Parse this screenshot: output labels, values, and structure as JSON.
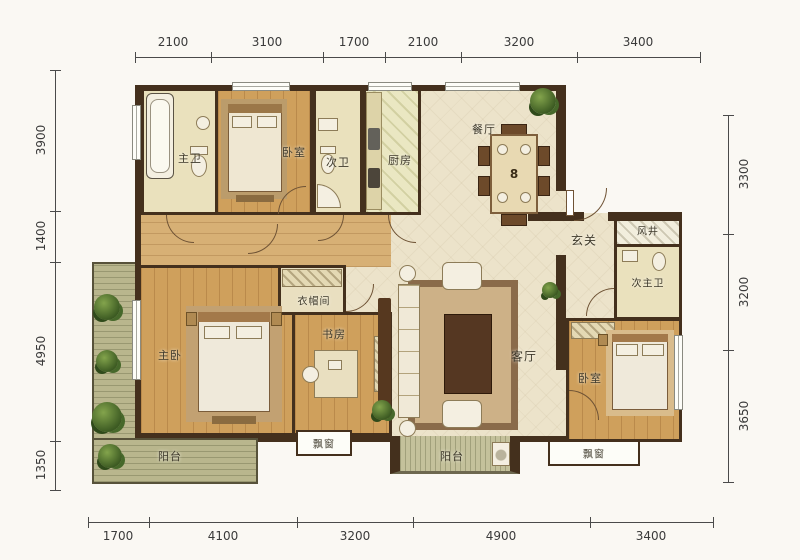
{
  "dimensions": {
    "top": [
      "2100",
      "3100",
      "1700",
      "2100",
      "3200",
      "3400"
    ],
    "bottom": [
      "1700",
      "4100",
      "3200",
      "4900",
      "3400"
    ],
    "left": [
      "3900",
      "1400",
      "4950",
      "1350"
    ],
    "right": [
      "3300",
      "3200",
      "3650"
    ]
  },
  "rooms": {
    "master_bath": "主卫",
    "bedroom_top": "卧室",
    "second_bath": "次卫",
    "kitchen": "厨房",
    "dining": "餐厅",
    "foyer": "玄关",
    "air_shaft": "风井",
    "second_master_bath": "次主卫",
    "cloakroom": "衣帽间",
    "master_bedroom": "主卧",
    "study": "书房",
    "living": "客厅",
    "bedroom_right": "卧室",
    "balcony_left": "阳台",
    "bay_window_left": "飘窗",
    "balcony_mid": "阳台",
    "bay_window_right": "飘窗"
  },
  "markers": {
    "dining_seats": "8"
  },
  "icons": [
    "plant-icon",
    "bathtub-icon",
    "toilet-icon",
    "sink-icon",
    "bed-icon",
    "sofa-icon",
    "armchair-icon",
    "coffee-table-icon",
    "dining-table-icon",
    "chair-icon",
    "desk-icon",
    "wardrobe-icon",
    "door-arc-icon",
    "window-icon",
    "washer-icon",
    "tv-cabinet-icon"
  ],
  "colors": {
    "wall": "#44301d",
    "floor_cream": "#ece3ca",
    "floor_wood": "#cfa05c",
    "floor_bath": "#eae1bd",
    "floor_kitchen": "#eae7c2",
    "floor_balcony": "#b9b68d",
    "plant_green": "#4e6e2e",
    "dim_text": "#3a3a3a"
  }
}
